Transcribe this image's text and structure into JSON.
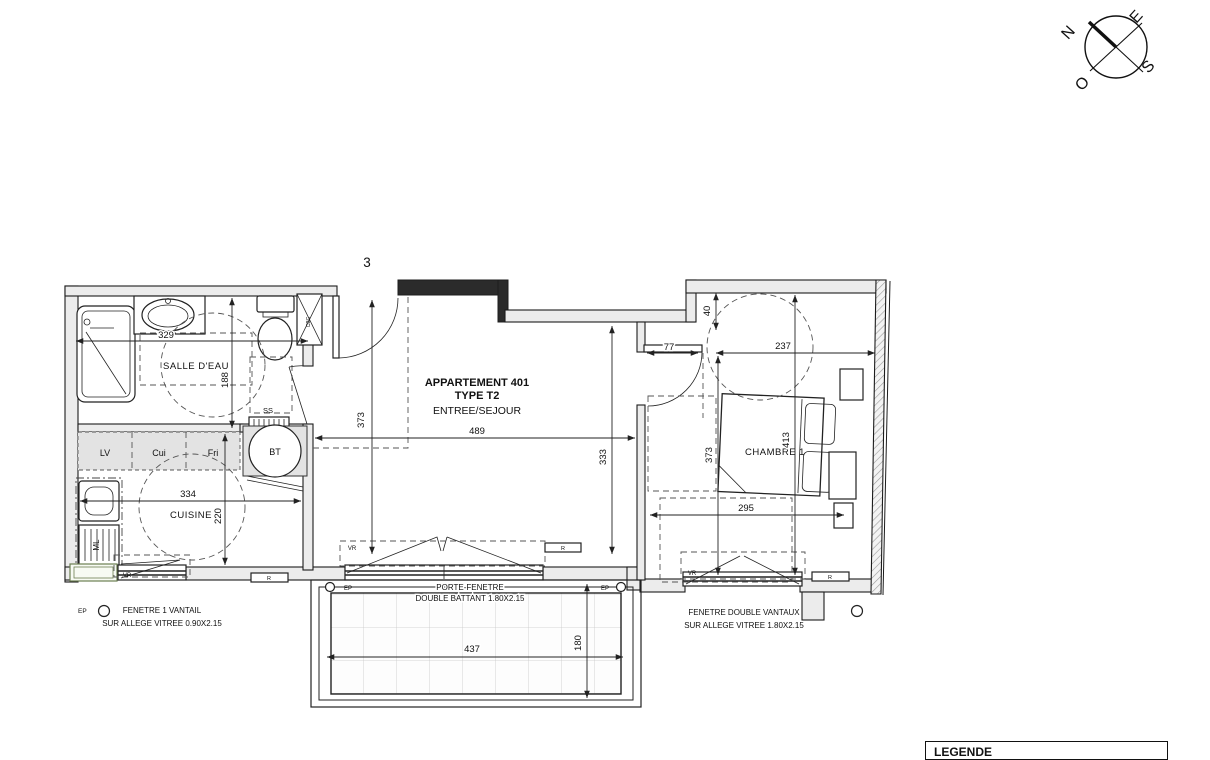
{
  "sheet": {
    "number": "3",
    "legend_title": "LEGENDE"
  },
  "compass": {
    "n": "N",
    "e": "E",
    "s": "S",
    "o": "O"
  },
  "apartment": {
    "line1": "APPARTEMENT 401",
    "line2": "TYPE T2",
    "line3": "ENTREE/SEJOUR"
  },
  "rooms": {
    "salle_eau": "SALLE D'EAU",
    "cuisine": "CUISINE",
    "chambre": "CHAMBRE 1"
  },
  "fixtures": {
    "lv": "LV",
    "cui": "Cui",
    "fri": "Fri",
    "bt": "BT",
    "ml": "ML",
    "ss": "SS",
    "cbc": "CBC",
    "vr": "VR",
    "r": "R",
    "ep": "EP"
  },
  "dims": {
    "salle_eau_width": "329",
    "salle_eau_depth": "188",
    "cuisine_width": "334",
    "cuisine_depth": "220",
    "sejour_depth": "373",
    "sejour_width": "489",
    "sejour_depth2": "333",
    "chambre_offset": "40",
    "chambre_stub": "77",
    "chambre_width": "237",
    "chambre_depth": "373",
    "chambre_depth2": "413",
    "chambre_width2": "295",
    "balcon_width": "437",
    "balcon_depth": "180"
  },
  "annotations": {
    "window_left": [
      "FENETRE 1 VANTAIL",
      "SUR ALLEGE VITREE 0.90X2.15"
    ],
    "door_window": [
      "PORTE-FENETRE",
      "DOUBLE BATTANT 1.80X2.15"
    ],
    "window_right": [
      "FENETRE DOUBLE VANTAUX",
      "SUR ALLEGE VITREE 1.80X2.15"
    ]
  }
}
